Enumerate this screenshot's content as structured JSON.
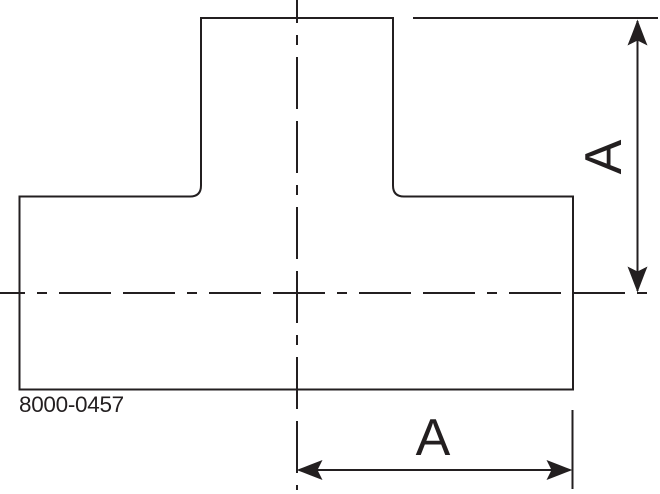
{
  "figure": {
    "type": "technical-drawing",
    "subject": "butt-weld-tee-fitting-front-view",
    "part_number": "8000-0457",
    "dim_vertical_label": "A",
    "dim_horizontal_label": "A",
    "line_color": "#231F20",
    "background_color": "#FFFFFF"
  }
}
